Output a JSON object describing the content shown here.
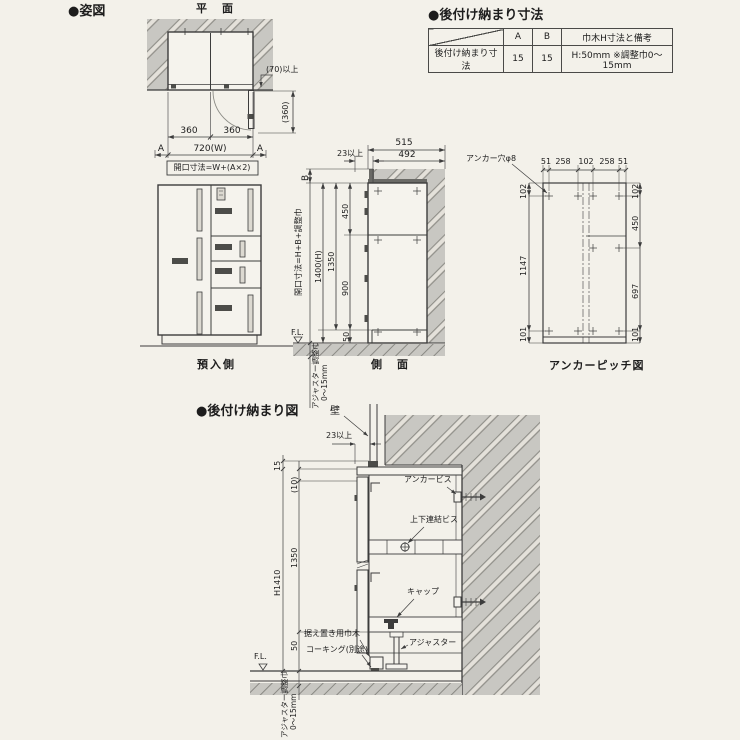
{
  "colors": {
    "bg": "#f3f1ea",
    "line": "#3c3c3c",
    "wall_fill": "#c8c7c2",
    "plate": "#4c4c49"
  },
  "titles": {
    "figure": "●姿図",
    "plan": "平　面",
    "front": "預入側",
    "side": "側　面",
    "anchor": "アンカーピッチ図",
    "table": "●後付け納まり寸法",
    "detail": "●後付け納まり図"
  },
  "table": {
    "col_a": "A",
    "col_b": "B",
    "col_note": "巾木H寸法と備考",
    "row_label": "後付け納まり寸法",
    "val_a": "15",
    "val_b": "15",
    "val_note": "H:50mm ※調整巾0〜15mm"
  },
  "plan": {
    "w_left": "360",
    "w_right": "360",
    "w_total": "720(W)",
    "a_left": "A",
    "a_right": "A",
    "formula": "開口寸法=W+(A×2)",
    "wall_min": "(70)以上",
    "door_swing": "(360)"
  },
  "side": {
    "total_depth": "515",
    "clearance": "23以上",
    "depth": "492",
    "b": "B",
    "formula": "開口寸法=H+B+調整巾",
    "height": "1400(H)",
    "body": "1350",
    "upper": "450",
    "lower": "900",
    "base": "50",
    "fl": "F.L.",
    "adj_label": "アジャスター調整巾",
    "adj_range": "0〜15mm"
  },
  "anchor": {
    "hole": "アンカー穴φ8",
    "top": [
      "51",
      "258",
      "102",
      "258",
      "51"
    ],
    "left": [
      "102",
      "1147",
      "101"
    ],
    "right": [
      "102",
      "450",
      "697",
      "101"
    ]
  },
  "detail": {
    "wall": "壁",
    "clearance": "23以上",
    "anchor_screw": "アンカービス",
    "joint_screw": "上下連結ビス",
    "cap": "キャップ",
    "baseboard": "据え置き用巾木",
    "caulking": "コーキング(別途)",
    "adjuster": "アジャスター",
    "fl": "F.L.",
    "gap15": "15",
    "gap10": "(10)",
    "body": "1350",
    "total": "H1410",
    "base": "50",
    "adj_label": "アジャスター調整巾",
    "adj_range": "0〜15mm"
  }
}
